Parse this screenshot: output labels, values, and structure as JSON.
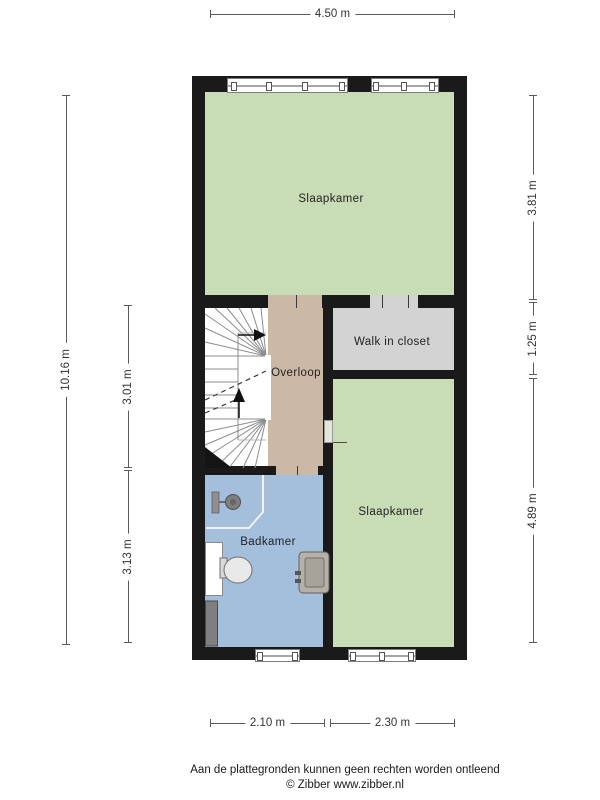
{
  "rooms": {
    "bedroom_top": {
      "label": "Slaapkamer"
    },
    "landing": {
      "label": "Overloop"
    },
    "closet": {
      "label": "Walk in closet"
    },
    "bathroom": {
      "label": "Badkamer"
    },
    "bedroom_bottom": {
      "label": "Slaapkamer"
    }
  },
  "dimensions": {
    "top": "4.50 m",
    "left_total": "10.16 m",
    "left_mid": "3.01 m",
    "left_bottom": "3.13 m",
    "right_top": "3.81 m",
    "right_mid": "1.25 m",
    "right_bottom": "4.89 m",
    "bottom_left": "2.10 m",
    "bottom_right": "2.30 m"
  },
  "footer": {
    "disclaimer": "Aan de plattegronden kunnen geen rechten worden ontleend",
    "credit": "© Zibber www.zibber.nl"
  },
  "colors": {
    "bedroom_green": "#c8ddb5",
    "landing_tan": "#cbb9a6",
    "closet_gray": "#d3d3d3",
    "bathroom_blue": "#a4bfdc",
    "wall_black": "#1a1a1a",
    "dimension_gray": "#555555"
  }
}
